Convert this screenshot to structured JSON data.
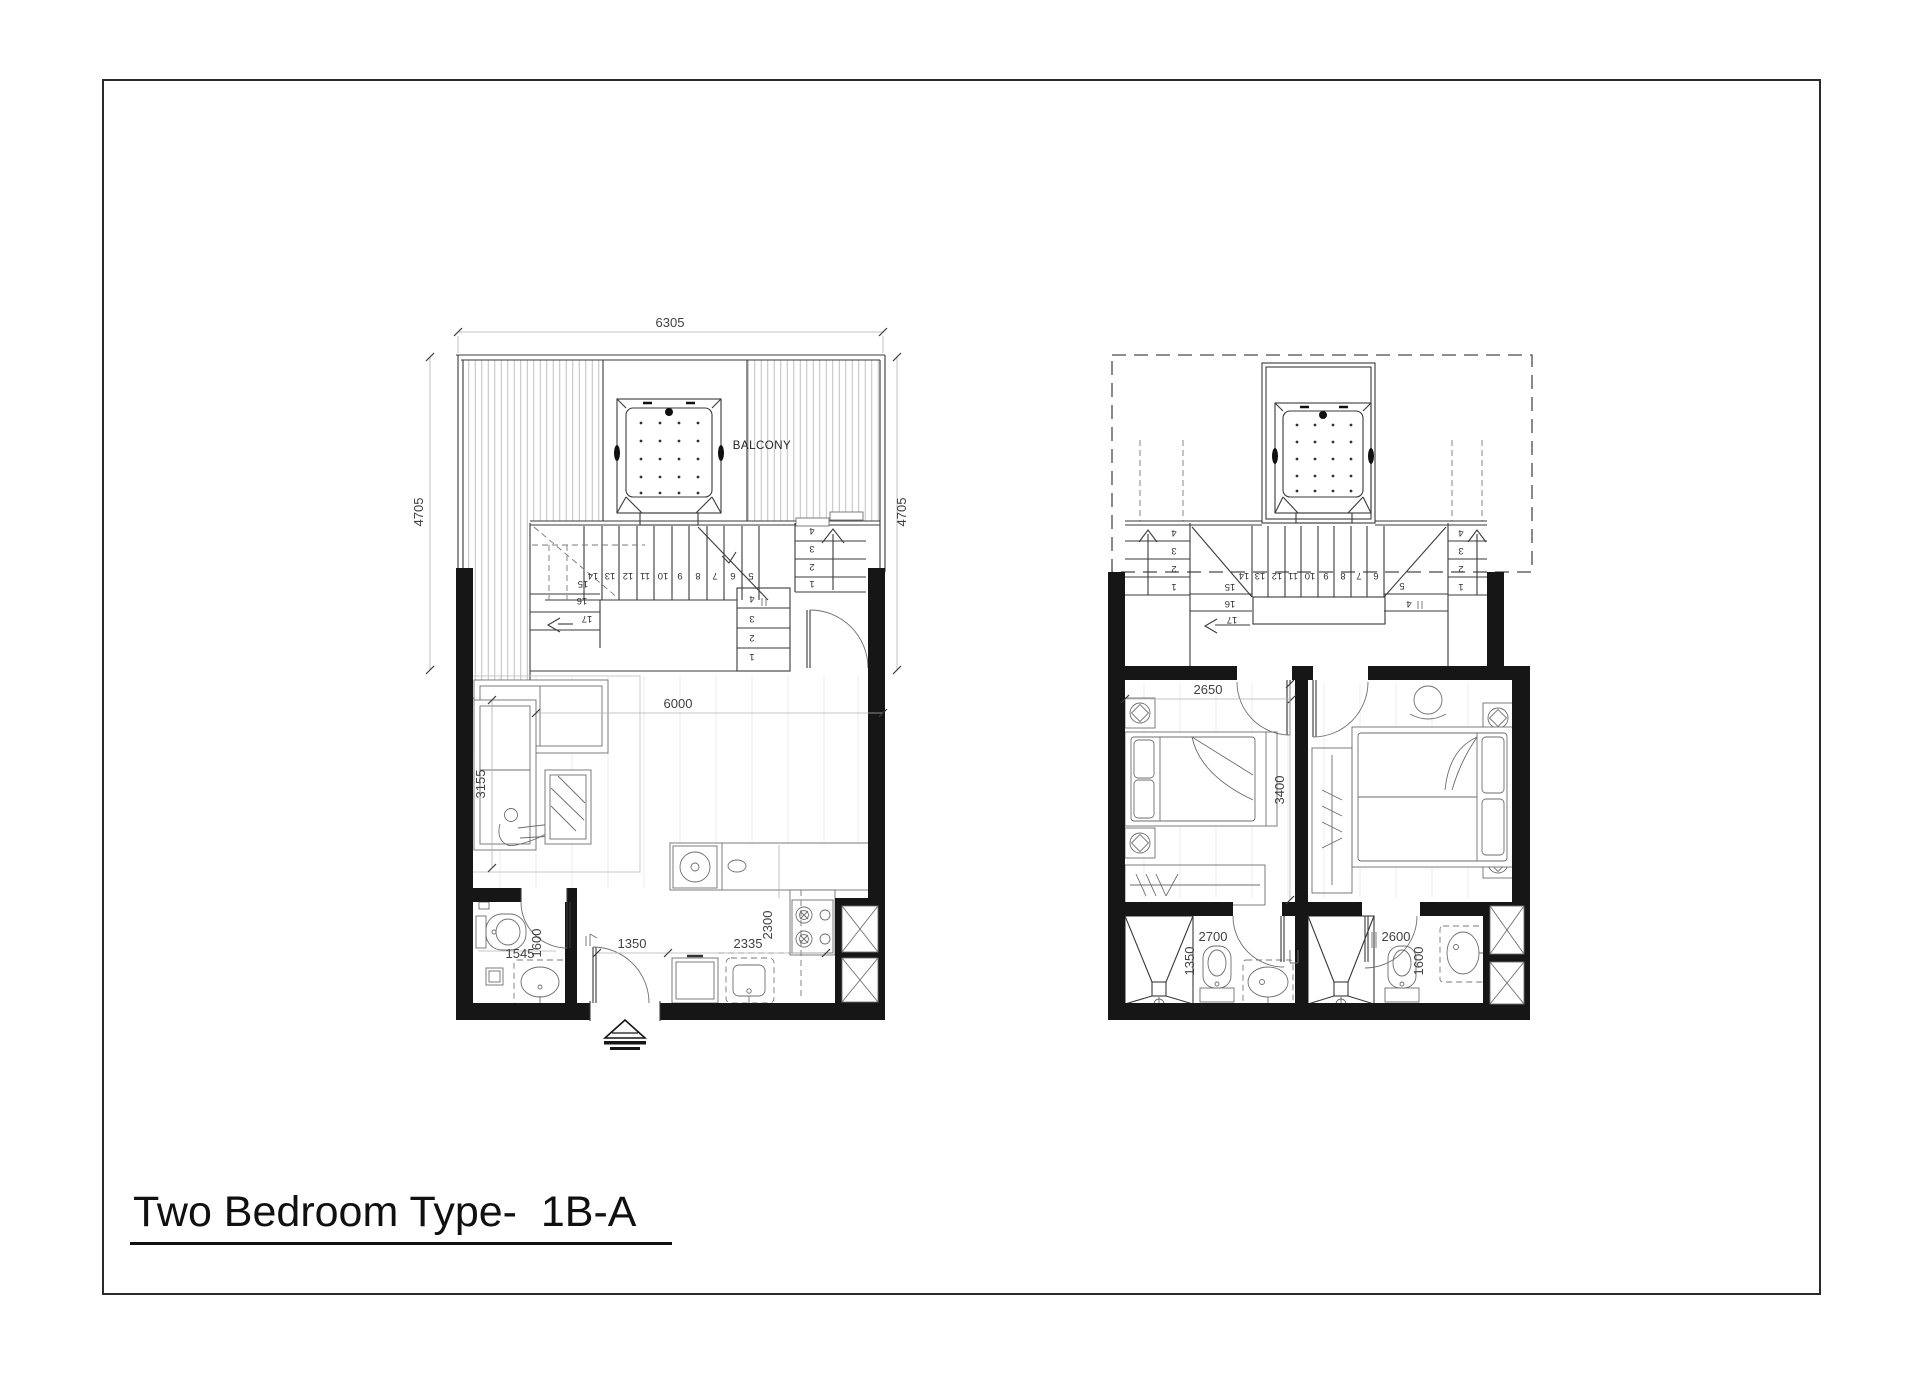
{
  "page": {
    "title": "Two Bedroom Type-  1B-A"
  },
  "left_plan": {
    "balcony_label": "BALCONY",
    "dims": {
      "overall_width": "6305",
      "side_left": "4705",
      "side_right": "4705",
      "living_width": "6000",
      "living_depth": "3155",
      "bath_width": "1545",
      "bath_depth": "1600",
      "entry": "1350",
      "kitchen_run": "2335",
      "kitchen_depth": "2300"
    },
    "stairs": {
      "run": [
        "14",
        "13",
        "12",
        "11",
        "10",
        "9",
        "8",
        "7",
        "6",
        "5"
      ],
      "winders": [
        "15",
        "16",
        "17"
      ],
      "mid_flight": [
        "4",
        "3",
        "2",
        "1"
      ],
      "entry_flight": [
        "4",
        "3",
        "2",
        "1"
      ]
    }
  },
  "right_plan": {
    "dims": {
      "bedroom_width": "2650",
      "bedroom_depth": "3400",
      "bath1_width": "2700",
      "bath1_depth": "1350",
      "bath2_width": "2600",
      "bath2_depth": "1600"
    },
    "stairs": {
      "run": [
        "14",
        "13",
        "12",
        "11",
        "10",
        "9",
        "8",
        "7",
        "6"
      ],
      "tread_5": "5",
      "tread_4": "4",
      "winders": [
        "15",
        "16",
        "17"
      ],
      "left_flight": [
        "4",
        "3",
        "2",
        "1"
      ],
      "right_flight": [
        "4",
        "3",
        "2",
        "1"
      ]
    }
  }
}
